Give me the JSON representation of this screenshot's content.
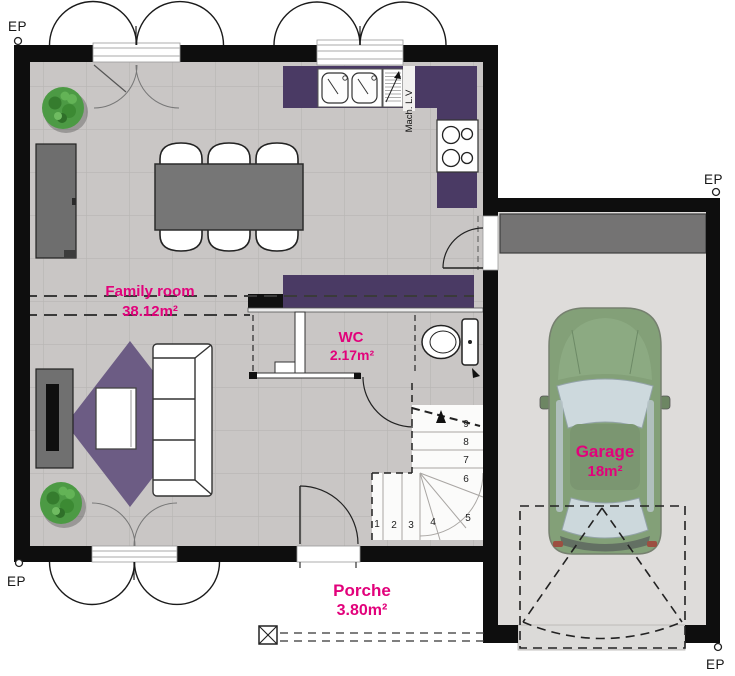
{
  "title": "Ground floor plan",
  "rooms": {
    "family_room": {
      "label": "Family room",
      "area": "38.12m²"
    },
    "wc": {
      "label": "WC",
      "area": "2.17m²"
    },
    "garage": {
      "label": "Garage",
      "area": "18m²"
    },
    "porch": {
      "label": "Porche",
      "area": "3.80m²"
    }
  },
  "annotations": {
    "dishwasher": "Mach. L.V",
    "rain_downspout": "EP"
  },
  "stairs": {
    "steps": [
      "1",
      "2",
      "3",
      "4",
      "5",
      "6",
      "7",
      "8",
      "9"
    ]
  },
  "icons": [
    "tree-plant-icon",
    "toilet-icon",
    "sink-icon",
    "cooktop-icon",
    "car-icon",
    "drain-icon"
  ],
  "colors": {
    "wall": "#0e0e0e",
    "floor_tile": "#c9c6c5",
    "garage_floor": "#dedcda",
    "kitchen_counter": "#4a3a64",
    "rug": "#6c5c84",
    "label_accent": "#e2017b",
    "car_body": "#83a078",
    "tree": "#4c9a44",
    "storage_shelf": "#747373"
  }
}
